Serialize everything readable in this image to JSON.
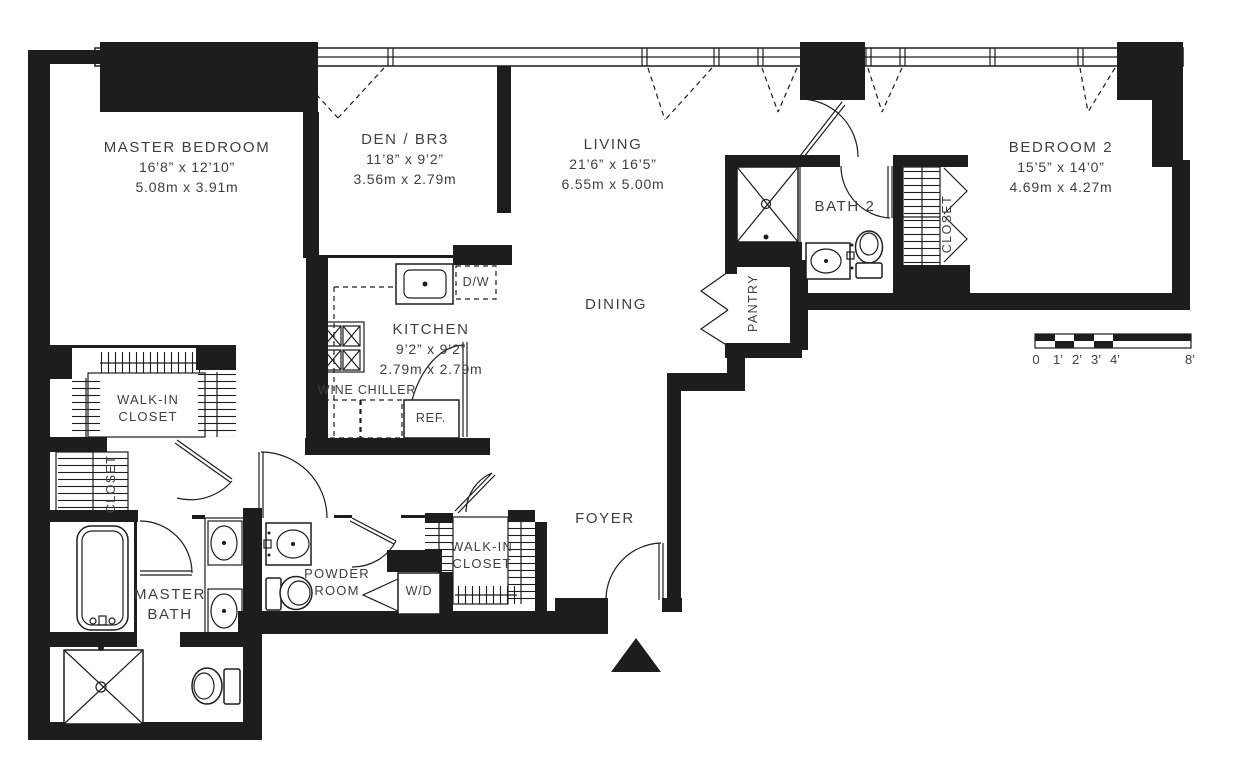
{
  "plan": {
    "rooms": {
      "master_bedroom": {
        "name": "MASTER BEDROOM",
        "dims_ft": "16’8” x 12’10”",
        "dims_m": "5.08m x 3.91m"
      },
      "den_br3": {
        "name": "DEN / BR3",
        "dims_ft": "11’8” x 9’2”",
        "dims_m": "3.56m x 2.79m"
      },
      "living": {
        "name": "LIVING",
        "dims_ft": "21’6” x 16’5”",
        "dims_m": "6.55m x 5.00m"
      },
      "bedroom_2": {
        "name": "BEDROOM 2",
        "dims_ft": "15’5” x 14’0”",
        "dims_m": "4.69m x 4.27m"
      },
      "kitchen": {
        "name": "KITCHEN",
        "dims_ft": "9’2” x 9’2”",
        "dims_m": "2.79m x 2.79m"
      },
      "dining": {
        "name": "DINING"
      },
      "bath_2": {
        "name": "BATH 2"
      },
      "pantry": {
        "name": "PANTRY"
      },
      "foyer": {
        "name": "FOYER"
      },
      "master_bath": {
        "name": "MASTER BATH"
      },
      "powder_room": {
        "name": "POWDER ROOM"
      },
      "master_walk_in_closet": {
        "name": "WALK-IN CLOSET"
      },
      "foyer_walk_in_closet": {
        "name": "WALK-IN CLOSET"
      },
      "master_closet": {
        "name": "CLOSET"
      },
      "bedroom_2_closet": {
        "name": "CLOSET"
      }
    },
    "appliances": {
      "dishwasher": "D/W",
      "refrigerator": "REF.",
      "washer_dryer": "W/D",
      "wine_chiller": "WINE CHILLER"
    },
    "scale_bar": {
      "labels": [
        "0",
        "1’",
        "2’",
        "3’",
        "4’",
        "8’"
      ]
    },
    "colors": {
      "wall": "#1d1d1b",
      "text": "#3f3f3f",
      "background": "#ffffff"
    }
  }
}
